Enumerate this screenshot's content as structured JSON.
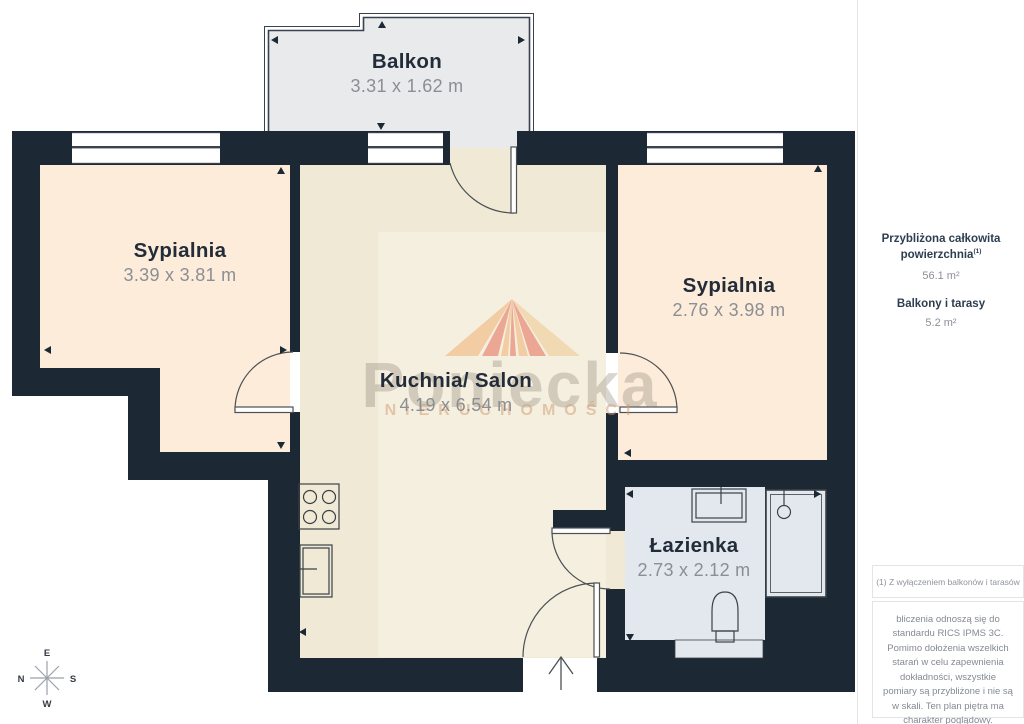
{
  "floor_plan": {
    "rooms": [
      {
        "id": "balkon",
        "name": "Balkon",
        "dims": "3.31 x 1.62 m"
      },
      {
        "id": "sypialnia-left",
        "name": "Sypialnia",
        "dims": "3.39 x 3.81 m"
      },
      {
        "id": "sypialnia-right",
        "name": "Sypialnia",
        "dims": "2.76 x 3.98 m"
      },
      {
        "id": "kuchnia-salon",
        "name": "Kuchnia/ Salon",
        "dims": "4.19 x 6.54 m"
      },
      {
        "id": "lazienka",
        "name": "Łazienka",
        "dims": "2.73 x 2.12 m"
      }
    ],
    "watermark": {
      "brand": "Poniecka",
      "subtitle": "NIERUCHOMOŚCI"
    },
    "compass": {
      "top": "E",
      "right": "S",
      "bottom": "W",
      "left": "N"
    }
  },
  "sidebar": {
    "total_area_label": "Przybliżona całkowita powierzchnia",
    "total_area_superscript": "(1)",
    "total_area_value": "56.1 m²",
    "balcony_label": "Balkony i tarasy",
    "balcony_value": "5.2 m²",
    "footnote": "(1) Z wyłączeniem balkonów i tarasów",
    "disclaimer": "bliczenia odnoszą się do standardu RICS IPMS 3C. Pomimo dołożenia wszelkich starań w celu zapewnienia dokładności, wszystkie pomiary są przybliżone i nie są w skali. Ten plan piętra ma charakter poglądowy.",
    "logo_text": "GIRAFFE",
    "logo_suffix": "360"
  },
  "colors": {
    "wall": "#1d2835",
    "bedroom_floor": "#fcecd9",
    "kitchen_floor": "#efe9d5",
    "rug": "#f5efdf",
    "balcony_floor": "#e9eaec",
    "bathroom_floor": "#e3e8ee",
    "dim_text": "#8b8e94",
    "label_text": "#232d3a",
    "sidebar_heading": "#2d3e50"
  }
}
